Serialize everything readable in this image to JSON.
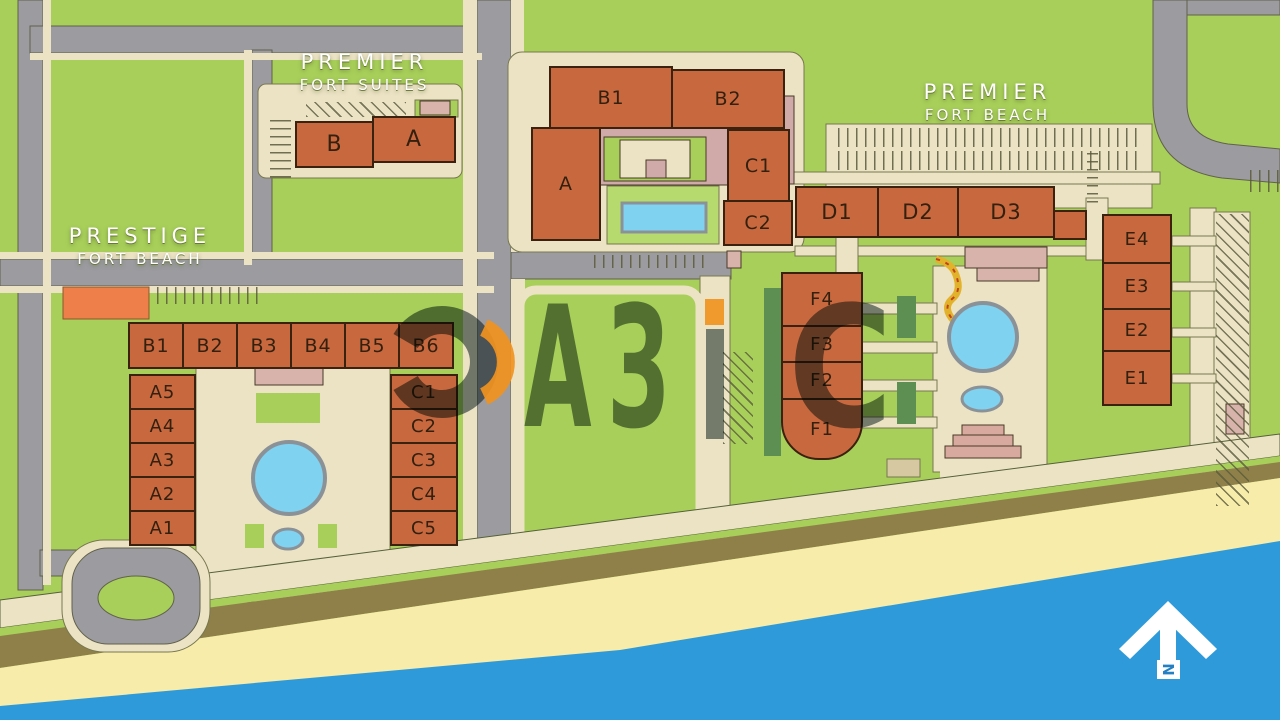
{
  "resorts": {
    "premier_fort_suites": {
      "line1": "PREMIER",
      "line2": "FORT SUITES"
    },
    "prestige_fort_beach": {
      "line1": "PRESTIGE",
      "line2": "FORT BEACH"
    },
    "premier_fort_beach": {
      "line1": "PREMIER",
      "line2": "FORT BEACH"
    }
  },
  "blocks": {
    "suites": [
      "B",
      "A"
    ],
    "central": {
      "b1": "B1",
      "b2": "B2",
      "a": "A",
      "c1": "C1",
      "c2": "C2"
    },
    "d_row": [
      "D1",
      "D2",
      "D3"
    ],
    "e_col": [
      "E4",
      "E3",
      "E2",
      "E1"
    ],
    "f_col": [
      "F4",
      "F3",
      "F2",
      "F1"
    ],
    "prestige_b_row": [
      "B1",
      "B2",
      "B3",
      "B4",
      "B5",
      "B6"
    ],
    "prestige_a_col": [
      "A5",
      "A4",
      "A3",
      "A2",
      "A1"
    ],
    "prestige_c_col": [
      "C1",
      "C2",
      "C3",
      "C4",
      "C5"
    ]
  },
  "watermark": {
    "brand": "ОАЗиС",
    "letters_az": "АЗ",
    "letter_s": "С"
  },
  "compass": {
    "label": "N"
  },
  "colors": {
    "green": "#a8cf5a",
    "terracotta": "#c8683e",
    "road_gray": "#9c9ca0",
    "path_beige": "#ece3c5",
    "pool_blue": "#7fd2f0",
    "sea_blue": "#2f9ad9",
    "sand": "#f7eca9",
    "dune": "#8f8049",
    "mauve": "#cfaaa8",
    "accent_orange": "#f0921e",
    "watermark_dark": "#263c3e"
  }
}
